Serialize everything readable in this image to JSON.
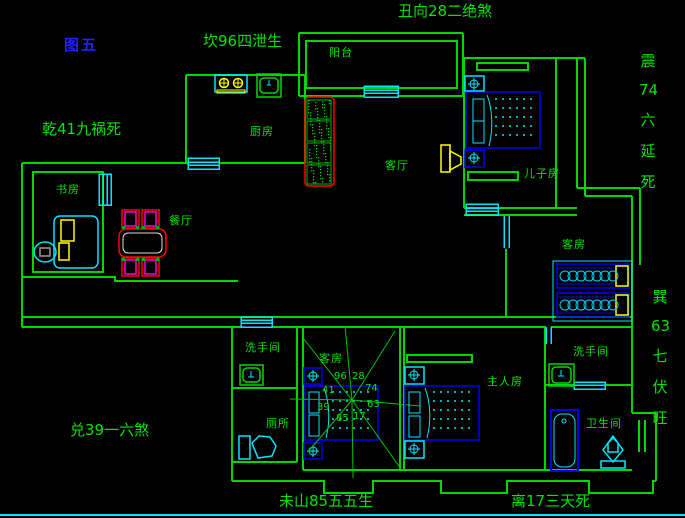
{
  "figure_label": "图五",
  "fengshui": {
    "top_center": "坎96四泄生",
    "top_right": "丑向28二绝煞",
    "left": "乾41九祸死",
    "bottom_left": "兑39一六煞",
    "bottom_center": "未山85五五生",
    "bottom_right": "离17三天死",
    "right_upper": [
      "震",
      "74",
      "六",
      "延",
      "死"
    ],
    "right_lower": [
      "巽",
      "63",
      "七",
      "伏",
      "旺"
    ]
  },
  "rooms": {
    "balcony": "阳台",
    "kitchen": "厨房",
    "study": "书房",
    "dining": "餐厅",
    "living": "客厅",
    "son_room": "儿子房",
    "guest_room_upper": "客房",
    "guest_room_lower": "客房",
    "washroom_left": "洗手间",
    "toilet": "厕所",
    "master_room": "主人房",
    "washroom_right": "洗手间",
    "bathroom": "卫生间"
  },
  "compass": {
    "nw": "41",
    "nnw": "96",
    "n": "28",
    "ne": "74",
    "e": "63",
    "se": "17",
    "s": "85",
    "w": "39"
  },
  "colors": {
    "background": "#000000",
    "wall_green": "#00d600",
    "text_green": "#00e400",
    "figure_blue": "#2222ff",
    "fixture_cyan": "#00e5ff",
    "furniture_blue": "#0000ee",
    "accent_yellow": "#ffff00",
    "accent_red": "#ff0000",
    "accent_magenta": "#ff00cc",
    "bottom_border_cyan": "#00e5ff"
  }
}
